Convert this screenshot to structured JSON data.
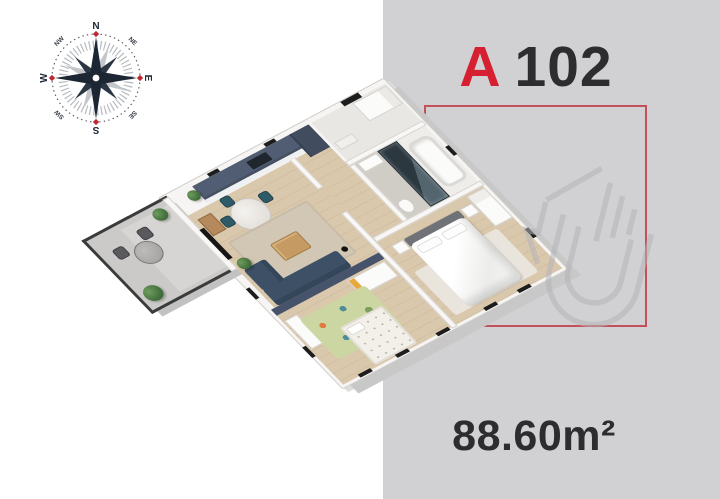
{
  "unit": {
    "prefix": "A",
    "number": "102",
    "area": "88.60m²"
  },
  "compass": {
    "n": "N",
    "ne": "NE",
    "e": "E",
    "se": "SE",
    "s": "S",
    "sw": "SW",
    "w": "W",
    "nw": "NW"
  },
  "colors": {
    "accent_red": "#d61f30",
    "outline_red": "#c4505a",
    "panel_gray": "#d1d1d3",
    "text_dark": "#2d2c2e",
    "compass_navy": "#1c2733",
    "kitchen_navy": "#4a5668",
    "sofa_navy": "#3d5066",
    "wood_floor": "#d8c5a9"
  }
}
